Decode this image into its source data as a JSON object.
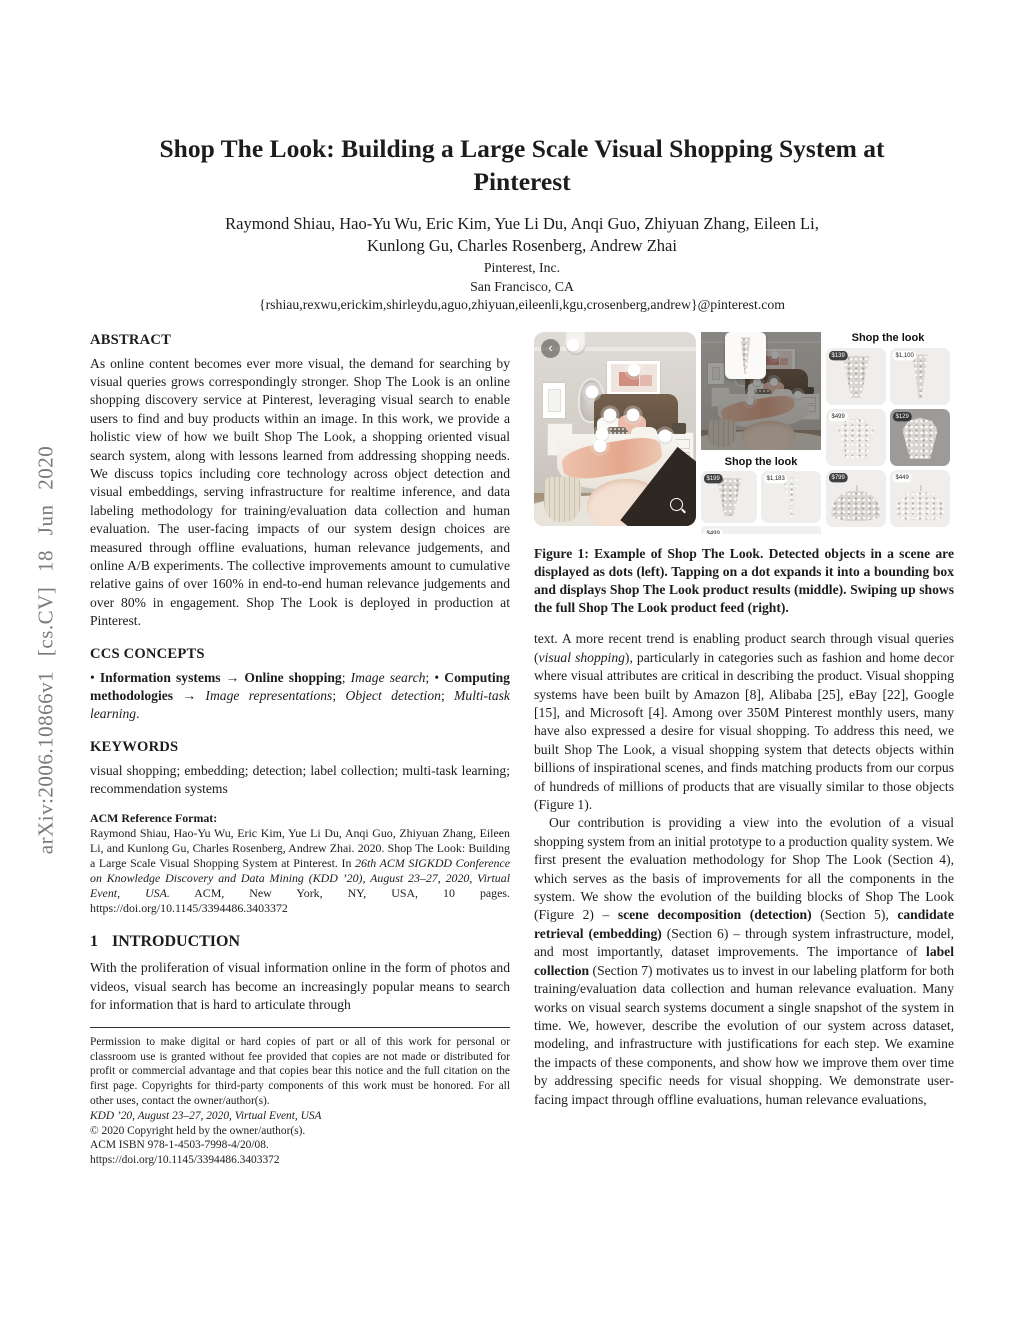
{
  "sidebar": {
    "arxiv_label": "arXiv:2006.10866v1 [cs.CV] 18 Jun 2020"
  },
  "header": {
    "title": "Shop The Look: Building a Large Scale Visual Shopping System at Pinterest",
    "authors_line1": "Raymond Shiau, Hao-Yu Wu, Eric Kim, Yue Li Du, Anqi Guo, Zhiyuan Zhang, Eileen Li,",
    "authors_line2": "Kunlong Gu, Charles Rosenberg, Andrew Zhai",
    "affiliation": "Pinterest, Inc.",
    "location": "San Francisco, CA",
    "email": "{rshiau,rexwu,erickim,shirleydu,aguo,zhiyuan,eileenli,kgu,crosenberg,andrew}@pinterest.com"
  },
  "abstract": {
    "heading": "ABSTRACT",
    "body": "As online content becomes ever more visual, the demand for searching by visual queries grows correspondingly stronger. Shop The Look is an online shopping discovery service at Pinterest, leveraging visual search to enable users to find and buy products within an image. In this work, we provide a holistic view of how we built Shop The Look, a shopping oriented visual search system, along with lessons learned from addressing shopping needs. We discuss topics including core technology across object detection and visual embeddings, serving infrastructure for realtime inference, and data labeling methodology for training/evaluation data collection and human evaluation. The user-facing impacts of our system design choices are measured through offline evaluations, human relevance judgements, and online A/B experiments. The collective improvements amount to cumulative relative gains of over 160% in end-to-end human relevance judgements and over 80% in engagement. Shop The Look is deployed in production at Pinterest."
  },
  "ccs": {
    "heading": "CCS CONCEPTS",
    "seg1": "• ",
    "seg2": "Information systems → Online shopping",
    "seg3": "; ",
    "seg4": "Image search",
    "seg5": "; • ",
    "seg6": "Computing methodologies",
    "seg7": " → ",
    "seg8": "Image representations",
    "seg9": "; ",
    "seg10": "Object detection",
    "seg11": "; ",
    "seg12": "Multi-task learning",
    "seg13": "."
  },
  "keywords": {
    "heading": "KEYWORDS",
    "body": "visual shopping; embedding; detection; label collection; multi-task learning; recommendation systems"
  },
  "acm_ref": {
    "heading": "ACM Reference Format:",
    "seg1": "Raymond Shiau, Hao-Yu Wu, Eric Kim, Yue Li Du, Anqi Guo, Zhiyuan Zhang, Eileen Li, and Kunlong Gu, Charles Rosenberg, Andrew Zhai. 2020. Shop The Look: Building a Large Scale Visual Shopping System at Pinterest. In ",
    "seg2": "26th ACM SIGKDD Conference on Knowledge Discovery and Data Mining (KDD ’20), August 23–27, 2020, Virtual Event, USA.",
    "seg3": " ACM, New York, NY, USA, 10 pages. ",
    "doi": "https://doi.org/10.1145/3394486.3403372"
  },
  "intro": {
    "number": "1",
    "heading": "INTRODUCTION",
    "body": "With the proliferation of visual information online in the form of photos and videos, visual search has become an increasingly popular means to search for information that is hard to articulate through"
  },
  "footnote": {
    "permission": "Permission to make digital or hard copies of part or all of this work for personal or classroom use is granted without fee provided that copies are not made or distributed for profit or commercial advantage and that copies bear this notice and the full citation on the first page. Copyrights for third-party components of this work must be honored. For all other uses, contact the owner/author(s).",
    "venue": "KDD ’20, August 23–27, 2020, Virtual Event, USA",
    "copyright": "© 2020 Copyright held by the owner/author(s).",
    "isbn": "ACM ISBN 978-1-4503-7998-4/20/08.",
    "doi": "https://doi.org/10.1145/3394486.3403372"
  },
  "figure": {
    "caption": "Figure 1: Example of Shop The Look. Detected objects in a scene are displayed as dots (left). Tapping on a dot expands it into a bounding box and displays Shop The Look product results (middle). Swiping up shows the full Shop The Look product feed (right).",
    "back_icon": "‹",
    "middle_panel": {
      "header": "Shop the look",
      "products": [
        {
          "price": "$199"
        },
        {
          "price": "$1,183"
        },
        {
          "price": "$499"
        }
      ]
    },
    "right_panel": {
      "header": "Shop the look",
      "products": [
        {
          "price": "$139"
        },
        {
          "price": "$1,100"
        },
        {
          "price": "$499"
        },
        {
          "price": "$129"
        },
        {
          "price": "$799"
        },
        {
          "price": "$449"
        }
      ]
    }
  },
  "col2": {
    "p1a": "text. A more recent trend is enabling product search through visual queries (",
    "p1b": "visual shopping",
    "p1c": "), particularly in categories such as fashion and home decor where visual attributes are critical in describing the product. Visual shopping systems have been built by Amazon [8], Alibaba [25], eBay [22], Google [15], and Microsoft [4]. Among over 350M Pinterest monthly users, many have also expressed a desire for visual shopping. To address this need, we built Shop The Look, a visual shopping system that detects objects within billions of inspirational scenes, and finds matching products from our corpus of hundreds of millions of products that are visually similar to those objects (Figure 1).",
    "p2a": "Our contribution is providing a view into the evolution of a visual shopping system from an initial prototype to a production quality system. We first present the evaluation methodology for Shop The Look (Section 4), which serves as the basis of improvements for all the components in the system. We show the evolution of the building blocks of Shop The Look (Figure 2) – ",
    "p2b": "scene decomposition (detection)",
    "p2c": " (Section 5), ",
    "p2d": "candidate retrieval (embedding)",
    "p2e": " (Section 6) – through system infrastructure, model, and most importantly, dataset improvements. The importance of ",
    "p2f": "label collection",
    "p2g": " (Section 7) motivates us to invest in our labeling platform for both training/evaluation data collection and human relevance evaluation. Many works on visual search systems document a single snapshot of the system in time. We, however, describe the evolution of our system across dataset, modeling, and infrastructure with justifications for each step. We examine the impacts of these components, and show how we improve them over time by addressing specific needs for visual shopping. We demonstrate user-facing impact through offline evaluations, human relevance evaluations,"
  }
}
